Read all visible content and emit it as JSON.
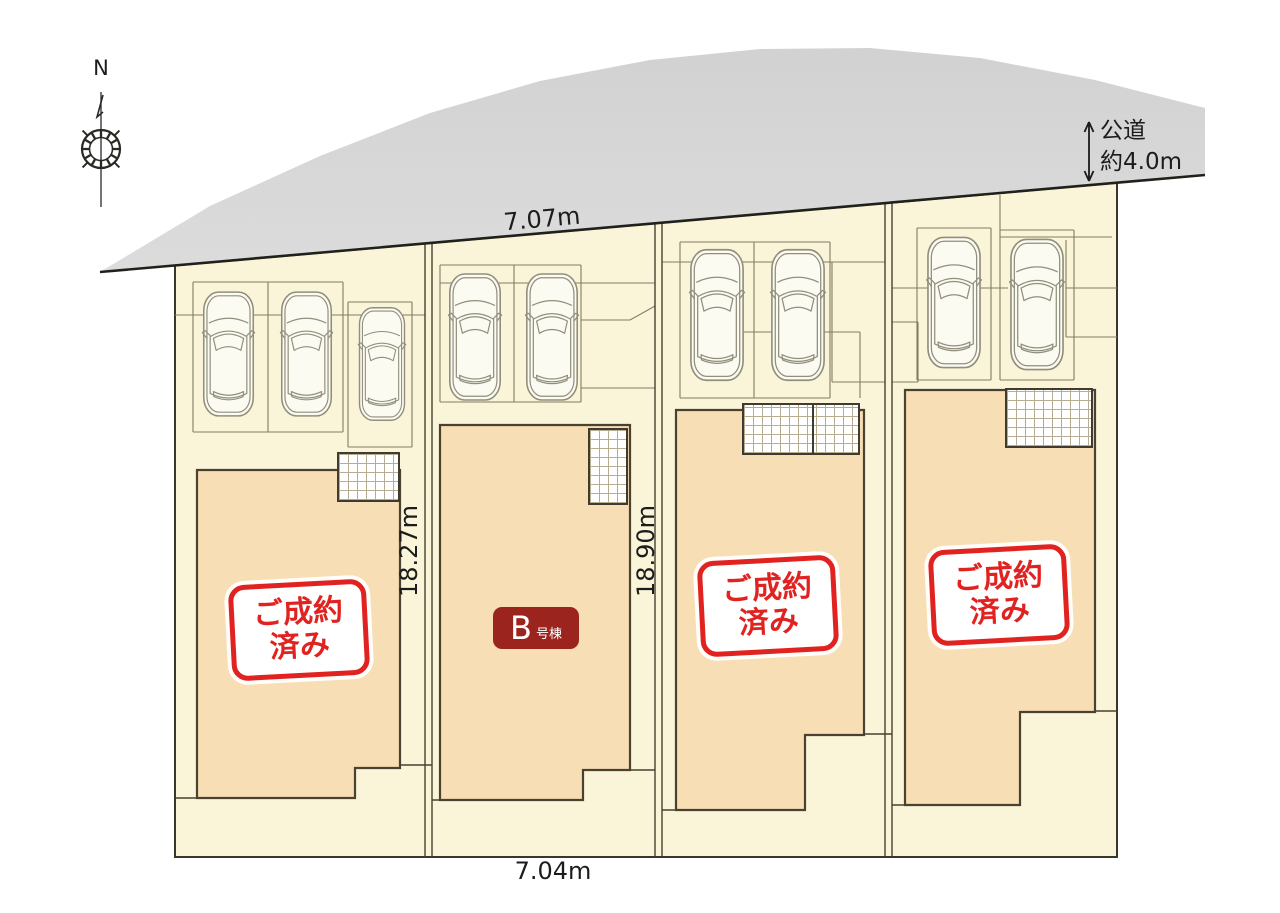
{
  "compass": {
    "north": "N"
  },
  "road": {
    "label_line1": "公道",
    "label_line2": "約4.0m"
  },
  "dimensions": {
    "top_width": "7.07m",
    "bottom_width": "7.04m",
    "depth_lot1": "18.27m",
    "depth_lot2": "18.90m"
  },
  "lots": [
    {
      "id": "lot-1",
      "status": "sold",
      "badge_line1": "ご成約",
      "badge_line2": "済み",
      "car_count": 3
    },
    {
      "id": "lot-2",
      "status": "for-sale",
      "unit_label": "B",
      "unit_suffix": "号棟",
      "car_count": 2
    },
    {
      "id": "lot-3",
      "status": "sold",
      "badge_line1": "ご成約",
      "badge_line2": "済み",
      "car_count": 2
    },
    {
      "id": "lot-4",
      "status": "sold",
      "badge_line1": "ご成約",
      "badge_line2": "済み",
      "car_count": 2
    }
  ],
  "colors": {
    "site_fill": "#faf5d8",
    "building_fill": "#f8deb4",
    "sold_badge_red": "#e02321",
    "unit_badge_dark_red": "#9c241e",
    "road_gray": "#dedede"
  }
}
